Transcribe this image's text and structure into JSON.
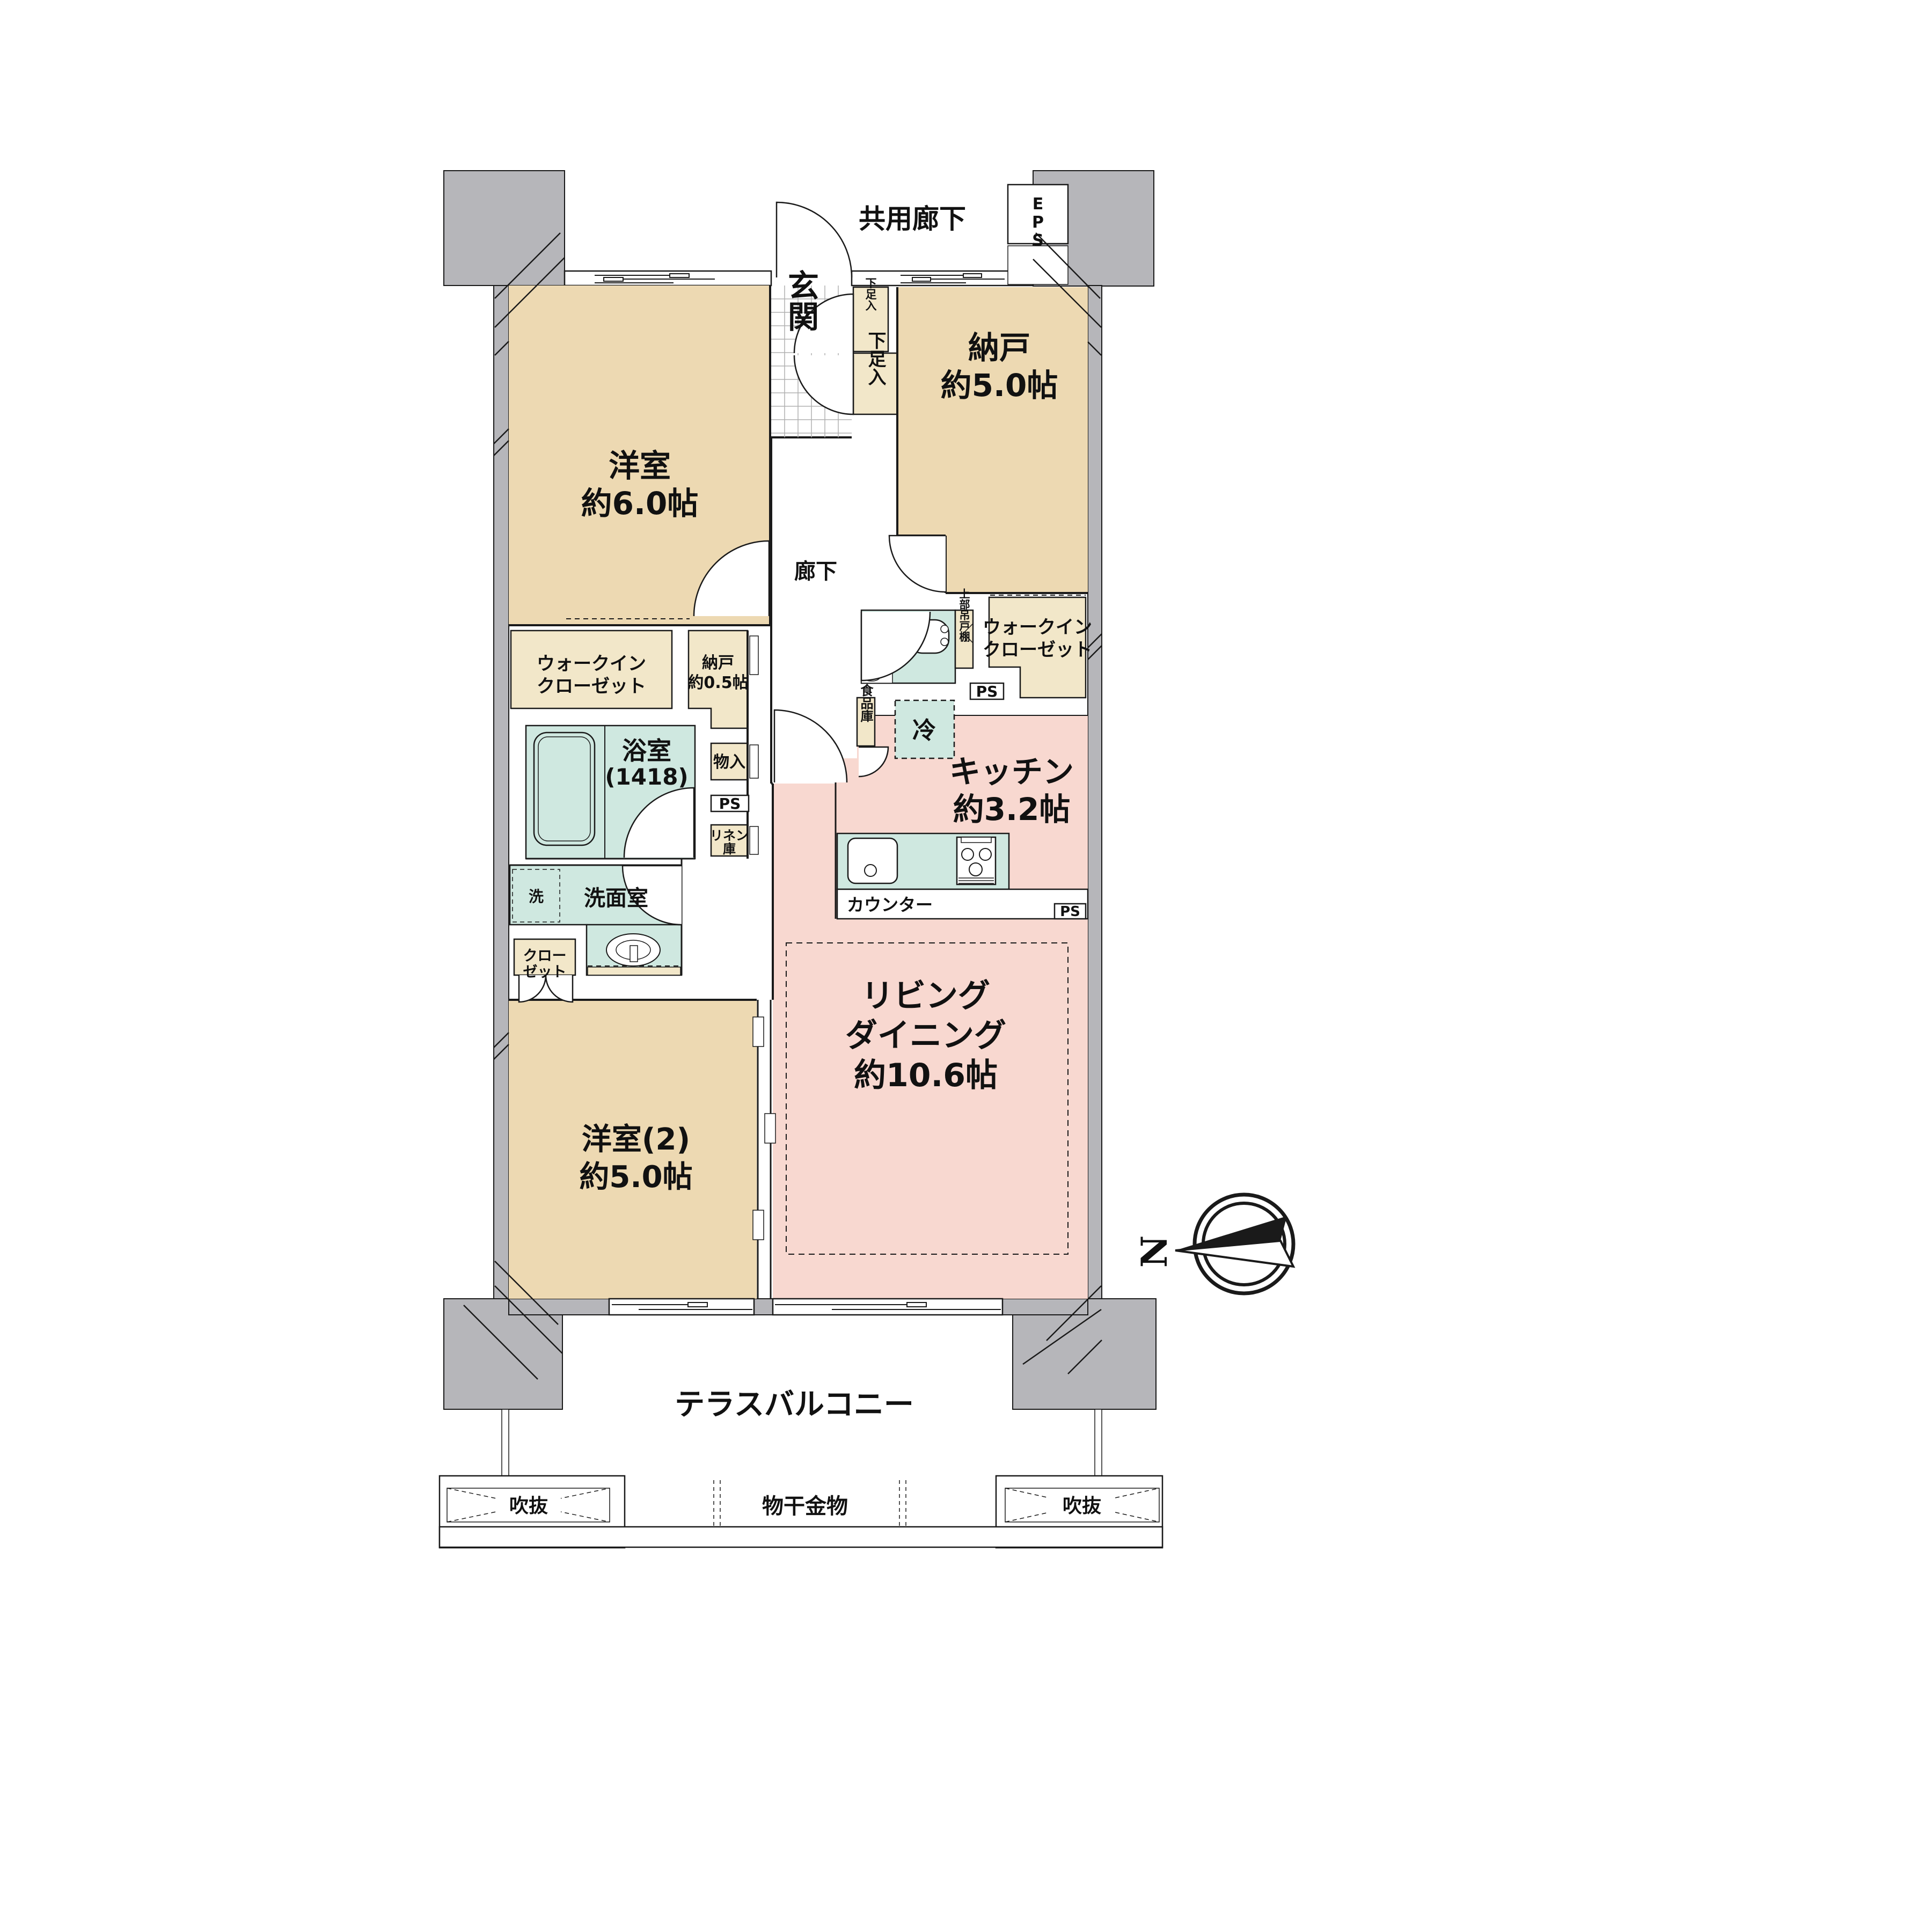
{
  "title": "マンション間取り図",
  "colors": {
    "wall_gray": "#b6b6ba",
    "room_beige": "#edd9b2",
    "closet_beige": "#f2e7c9",
    "water_teal": "#cfe8e0",
    "living_pink": "#f8d8d0",
    "line": "#1a1a1a"
  },
  "plan": {
    "common_corridor": "共用廊下",
    "eps": [
      "E",
      "P",
      "S"
    ],
    "genkan": "玄関",
    "shoe_small": "下足入",
    "shoe_large": "下足入",
    "hallway": "廊下",
    "bedroom1": {
      "name": "洋室",
      "size": "約6.0帖"
    },
    "storage_room": {
      "name": "納戸",
      "size": "約5.0帖"
    },
    "wic_left": [
      "ウォークイン",
      "クローゼット"
    ],
    "wic_right": [
      "ウォークイン",
      "クローゼット"
    ],
    "storage_small": [
      "納戸",
      "約0.5帖"
    ],
    "bath": {
      "name": "浴室",
      "size": "(1418)"
    },
    "storage_box": "物入",
    "ps_upper": "PS",
    "ps_mid": "PS",
    "ps_kitchen": "PS",
    "linen": [
      "リネン",
      "庫"
    ],
    "upper_cabinet": "上部吊戸棚",
    "pantry": "食品庫",
    "fridge": "冷",
    "kitchen": {
      "name": "キッチン",
      "size": "約3.2帖"
    },
    "counter": "カウンター",
    "washer": "洗",
    "powder_room": "洗面室",
    "closet": [
      "クロー",
      "ゼット"
    ],
    "bedroom2": {
      "name": "洋室(2)",
      "size": "約5.0帖"
    },
    "living": [
      "リビング",
      "ダイニング",
      "約10.6帖"
    ],
    "balcony": "テラスバルコニー",
    "void_left": "吹抜",
    "void_right": "吹抜",
    "drying": "物干金物",
    "north": "N"
  }
}
